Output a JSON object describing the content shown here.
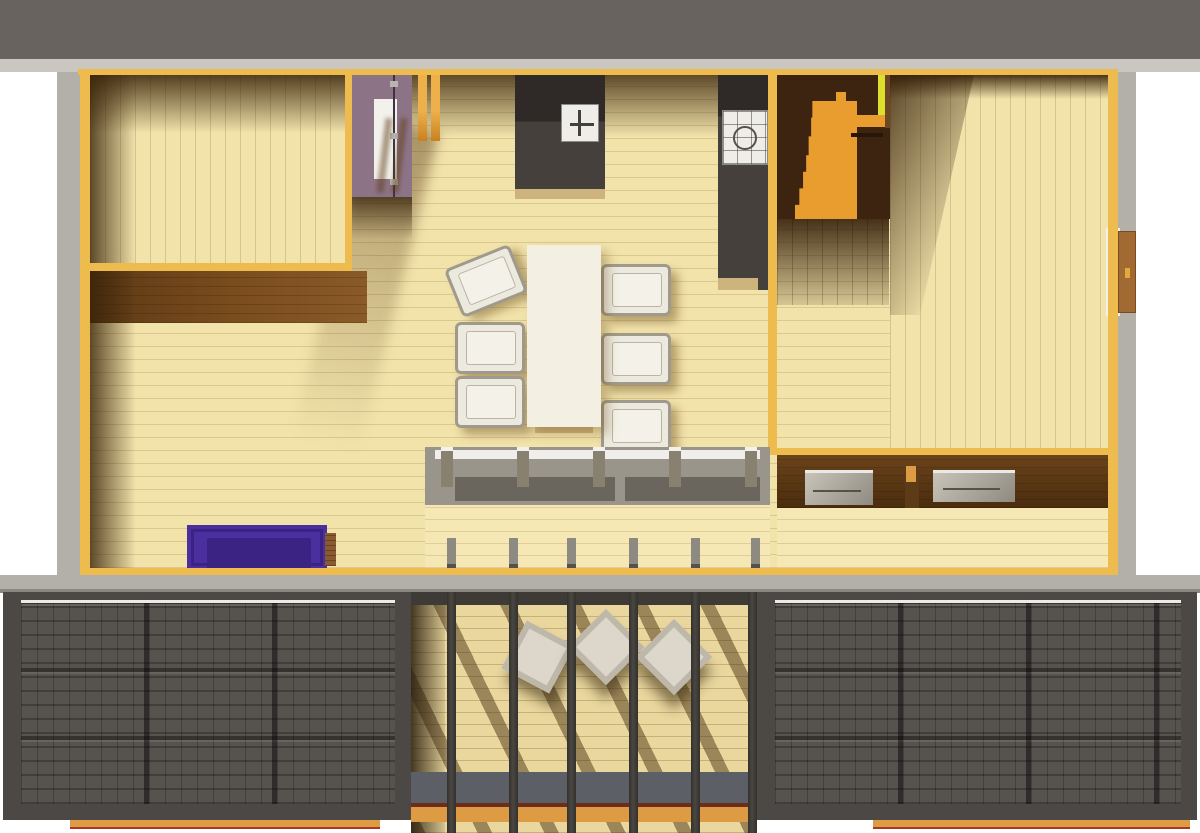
{
  "meta": {
    "kind": "architectural-floorplan-3d-render",
    "description": "Top-down rendered floor plan of a timber house: bedroom, living area with purple sofa, central dining table with six chairs, kitchen island with sink, counter with cooktop, winder staircase, right-hand room with entry door, glazed south wall, central covered porch with three lounge chairs between dark tiled roof sections"
  },
  "palette": {
    "roof-band": "#696360",
    "eaves": "#cac7c0",
    "exterior": "#b3b0aa",
    "wall-yellow": "#eebb4e",
    "wood-light": "#f2e3ab",
    "wood-sunlit": "#f6e8b4",
    "counter-base": "#cdb37c",
    "kitchen-dark": "#46403d",
    "stair-orange": "#e89d2e",
    "stair-dark": "#3c2410",
    "accent-yellowgreen": "#dce02b",
    "mauve": "#8d7386",
    "door-white": "#f3f1ec",
    "door-brown": "#a06a32",
    "sofa-purple": "#4b2f9e",
    "sofa-purple-dark": "#3a2383",
    "sofa-wood": "#8a5a30",
    "table-white": "#f3efe3",
    "chair-frame": "#a09a8c",
    "roof-tile-base": "#4c4845",
    "roof-tile": "#56524e",
    "porch-floor": "#e9d79e",
    "porch-sill": "#5c5f66",
    "fascia-orange": "#dd9b43",
    "fascia-red": "#b03522"
  },
  "rooms": [
    {
      "name": "bedroom-left",
      "floor": "vertical-planks"
    },
    {
      "name": "living-area",
      "floor": "horizontal-planks"
    },
    {
      "name": "central-hall-kitchen",
      "floor": "horizontal-planks"
    },
    {
      "name": "stairwell",
      "floor": "dark-with-orange-winder-stair"
    },
    {
      "name": "right-room",
      "floor": "vertical-planks"
    },
    {
      "name": "vestibule-south",
      "floor": "horizontal-planks"
    },
    {
      "name": "covered-porch",
      "floor": "horizontal-planks-shadowed"
    }
  ],
  "furniture": [
    {
      "name": "purple-sofa",
      "room": "living-area"
    },
    {
      "name": "dining-table",
      "room": "central-hall-kitchen",
      "chairs": 6
    },
    {
      "name": "kitchen-island-with-sink",
      "room": "central-hall-kitchen"
    },
    {
      "name": "kitchen-counter-with-cooktop",
      "room": "central-hall-kitchen"
    },
    {
      "name": "sideboard-left",
      "room": "right-room"
    },
    {
      "name": "sideboard-right",
      "room": "right-room"
    },
    {
      "name": "lounge-chairs",
      "room": "covered-porch",
      "count": 3
    },
    {
      "name": "entry-door",
      "room": "right-room"
    }
  ],
  "structure": {
    "roof_sections": [
      "top-eaves-band",
      "lower-left-tiled-roof",
      "lower-right-tiled-roof"
    ],
    "tiled_roof_grid": {
      "columns": 3,
      "rows": 3
    },
    "porch_rafters": 6,
    "glazing_posts": 5,
    "orange_posts_hall": 2
  }
}
